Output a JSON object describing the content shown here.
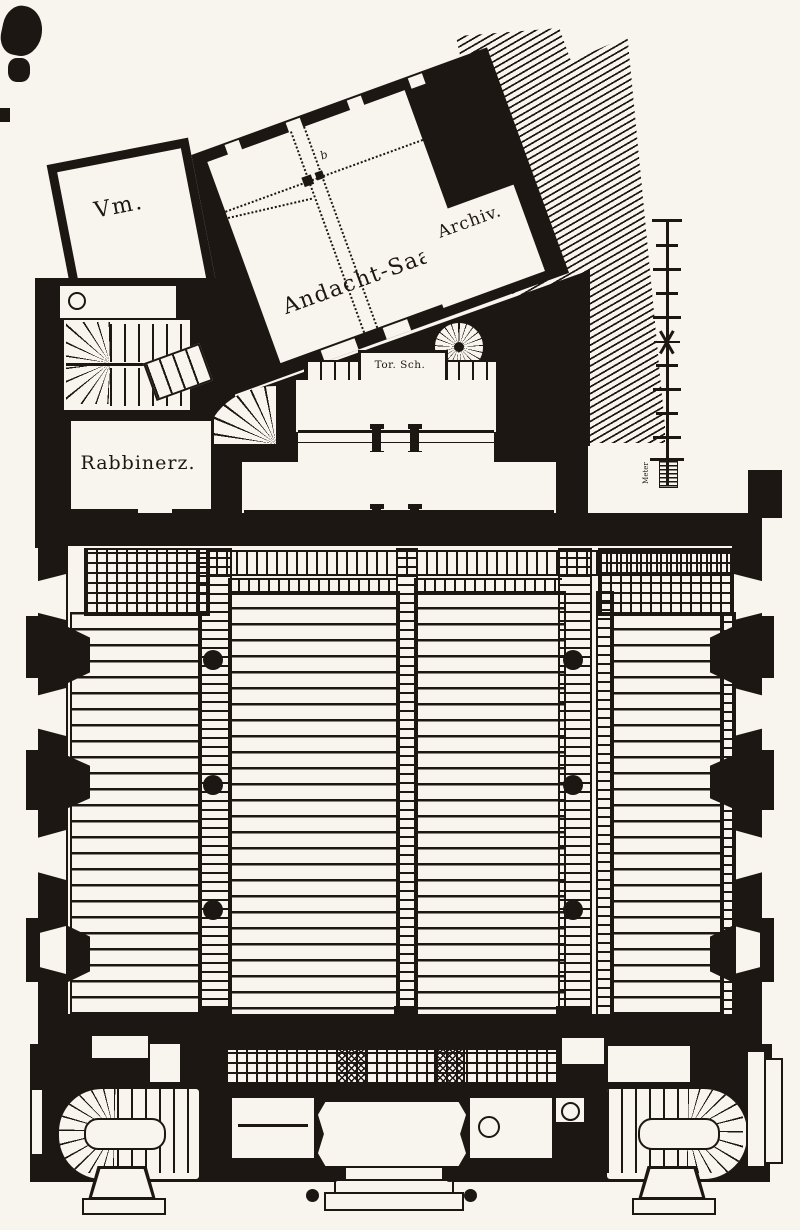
{
  "colors": {
    "ink": "#1c1712",
    "paper": "#f8f4ee"
  },
  "rooms": {
    "vestibule": {
      "label": "Vm."
    },
    "prayer_hall": {
      "label": "Andacht-Saal"
    },
    "archive": {
      "label": "Archiv."
    },
    "rabbi_room": {
      "label": "Rabbinerz."
    },
    "torah_shrine": {
      "label": "Tor. Sch."
    }
  },
  "annotations": {
    "grid_letter": "b",
    "scale_unit": "Meter"
  }
}
